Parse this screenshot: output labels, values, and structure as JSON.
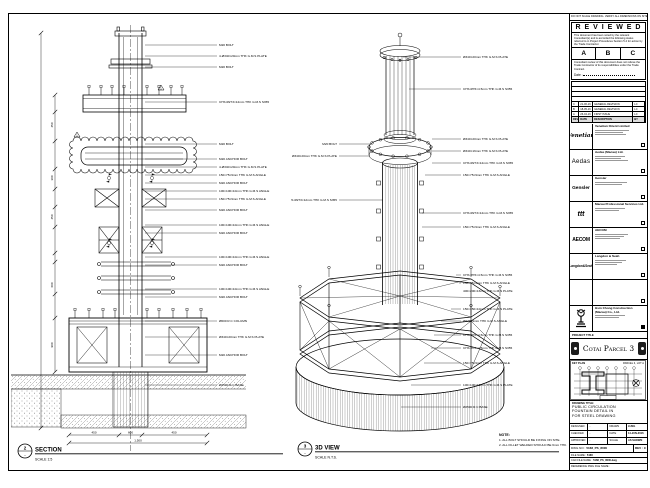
{
  "sheet": {
    "top_strip": "DO NOT SCALE DRAWING. VERIFY ALL DIMENSIONS ON SITE.",
    "stamp": {
      "title": "R E V I E W E D",
      "para1": "This document has been noted by the relevant Consultant(s) and is accorded the following status referred to in Project Procedures Section 5.4 for action by the Trade Contractor.",
      "columns": [
        "A",
        "B",
        "C"
      ],
      "para2": "Consultant review of this document does not relieve the Trade Contractor of its responsibilities under the Trade Contract.",
      "date_label": "Date :"
    },
    "revision_table": {
      "header": [
        "REV",
        "DATE",
        "DESCRIPTION",
        "BY"
      ],
      "rows": [
        [
          "C",
          "21-06-16",
          "GENERAL REVISION",
          "LC"
        ],
        [
          "B",
          "18-05-16",
          "GENERAL REVISION",
          "LC"
        ],
        [
          "A",
          "26-04-16",
          "FIRST ISSUE",
          "LC"
        ]
      ]
    },
    "companies": [
      {
        "logo": "Venetian",
        "name": "Venetian Orient Limited"
      },
      {
        "logo": "Aedas",
        "name": "Aedas (Macau) Ltd."
      },
      {
        "logo": "Gensler",
        "name": "Gensler"
      },
      {
        "logo": "ttt",
        "name": "Macau Professional Services Ltd."
      },
      {
        "logo": "AECOM",
        "name": "AECOM"
      },
      {
        "logo": "Langdon&Seah",
        "name": "Langdon & Seah"
      }
    ],
    "contractor": {
      "name_line1": "Hsin Chong Construction",
      "name_line2": "(Macau) Co., Ltd."
    },
    "project_title_label": "PROJECT TITLE",
    "project_title": "Cotai Parcel 3",
    "key_plan": {
      "label": "KEY PLAN",
      "lot": "PARCEL 3, LOT A"
    },
    "drawing_title_label": "DRAWING TITLE:",
    "drawing_title_lines": [
      "PUBLIC CIRCULATION",
      "FOUNTAIN DETAIL IN",
      "FOR STEEL DRAWING"
    ],
    "signoff": {
      "designed_label": "DESIGNED",
      "designed": "-",
      "drawn_label": "DRAWN",
      "drawn": "LUNG",
      "checked_label": "CHECKED",
      "checked": "-",
      "date_label": "DATE",
      "date": "14-JUN-2016",
      "approved_label": "APPROVED",
      "approved": "-",
      "scale_label": "SCALE",
      "scale": "AS SHOWN",
      "dwg_label": "DWG NO :",
      "dwg_no": "5168_PS_8000",
      "rev_label": "REV :",
      "rev": "C",
      "file_label": "FILE NAME :",
      "file_name": "5168",
      "cad_label": "CAD FILE NAME :",
      "cad_file": "5168_PS_8000.dwg",
      "ref_label": "REFERENCE DWG FILE NAME :"
    }
  },
  "section_view": {
    "marker": "2",
    "marker_ref": "-",
    "title": "SECTION",
    "scale": "SCALE 1:5",
    "labels": [
      "M20 BOLT",
      "4-Ø340×20mm THK G.M.S PLATE",
      "M20 BOLT",
      "CHS Ø273×12mm THK G.M.S S355",
      "M20 BOLT",
      "M20 ANCHOR BOLT",
      "4-Ø340×20mm THK G.M.S PLATE",
      "150×75×9mm THK G.M.S ANGLE",
      "M20 ANCHOR BOLT",
      "100×100×10mm THK G.M.S ANGLE",
      "150×75×9mm THK G.M.S ANGLE",
      "M20 ANCHOR BOLT",
      "100×100×10mm THK G.M.S ANGLE",
      "M20 ANCHOR BOLT",
      "100×100×10mm THK G.M.S ANGLE",
      "M20 ANCHOR BOLT",
      "100×100×10mm THK G.M.S ANGLE",
      "M20 ANCHOR BOLT",
      "Ø600 R.C COLUMN",
      "Ø340×20mm THK G.M.S PLATE",
      "M20 ANCHOR BOLT",
      "Ø2500 R.C BASE"
    ],
    "dims_v": [
      "450",
      "300",
      "450",
      "600",
      "900"
    ],
    "dims_h": [
      "450",
      "600",
      "450"
    ],
    "total_dim": "1,500",
    "rev_flag": "1"
  },
  "iso_view": {
    "marker": "3",
    "marker_ref": "-",
    "title": "3D VIEW",
    "scale": "SCALE N.T.S.",
    "labels_right": [
      "Ø340×20mm THK G.M.S PLATE",
      "CHS Ø76×4.5mm THK G.M.S S355",
      "Ø340×20mm THK G.M.S PLATE",
      "Ø340×16mm THK G.M.S PLATE",
      "CHS Ø273×12mm THK G.M.S S355",
      "150×75×9mm THK G.M.S ANGLE",
      "CHS Ø273×12mm THK G.M.S S355",
      "150×75×9mm THK G.M.S ANGLE",
      "CHS Ø76×4.5mm THK G.M.S S355",
      "150×75×9mm THK G.M.S ANGLE",
      "400×200×16mm THK G.M.S PLATE",
      "150×150×10mm THK G.M.S PLATE",
      "Ø273×9mm THK G.M.S ANGLE",
      "CHS Ø76×4.5mm THK G.M.S S355",
      "CHS Ø76×4.5mm THK G.M.S S355",
      "150×75×9mm THK G.M.S ANGLE",
      "100×100×10mm THK G.M.S PLATE",
      "Ø2500 R.C BASE"
    ],
    "labels_left": [
      "M20 BOLT",
      "Ø340×20mm THK G.M.S PLATE",
      "CHS Ø273×12mm THK G.M.S S355"
    ],
    "note_title": "NOTE:",
    "notes": [
      "1. ALL BOLT SHOULD BE FIXING ON SITE.",
      "2. ALL FILLET WELDED SHOULD BE 6mm THK."
    ]
  }
}
